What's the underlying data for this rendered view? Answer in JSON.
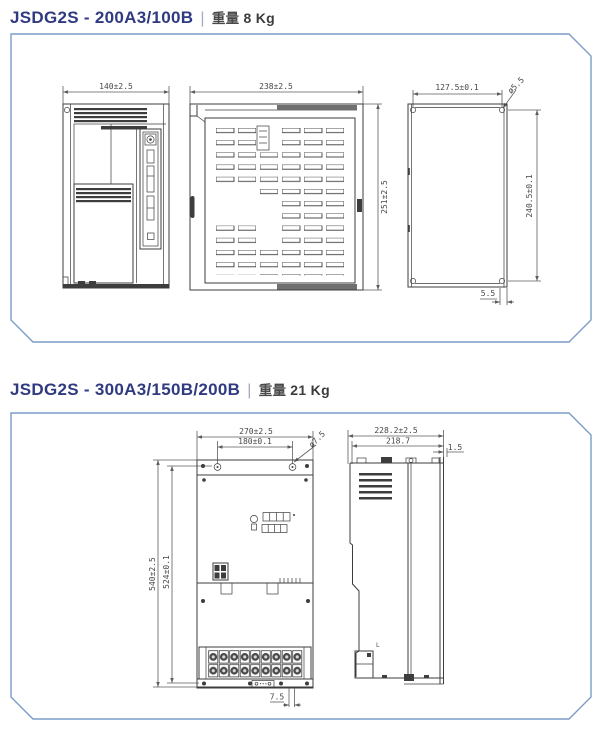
{
  "page": {
    "background": "#ffffff"
  },
  "colors": {
    "title_text": "#303a80",
    "separator": "#a4a9c4",
    "weight_text": "#3c3c3c",
    "panel_border": "#7b9cc9",
    "drawing_line": "#3d3d3d",
    "dimension_line": "#5d5d5d"
  },
  "section1": {
    "model": "JSDG2S - 200A3/100B",
    "separator": "|",
    "weight_label": "重量",
    "weight_value": "8 Kg",
    "front": {
      "width": "140±2.5"
    },
    "side": {
      "width": "238±2.5",
      "height": "251±2.5"
    },
    "back": {
      "width": "127.5±0.1",
      "height": "240.5±0.1",
      "hole": "ø5.5",
      "edge_offset": "5.5"
    }
  },
  "section2": {
    "model": "JSDG2S - 300A3/150B/200B",
    "separator": "|",
    "weight_label": "重量",
    "weight_value": "21 Kg",
    "front": {
      "width": "270±2.5",
      "hole_span": "180±0.1",
      "hole": "ø7.5",
      "height": "540±2.5",
      "inner_height": "524±0.1",
      "bottom_offset": "7.5"
    },
    "side": {
      "width": "228.2±2.5",
      "inner_width": "218.7",
      "flange": "1.5",
      "mark": "L"
    }
  }
}
